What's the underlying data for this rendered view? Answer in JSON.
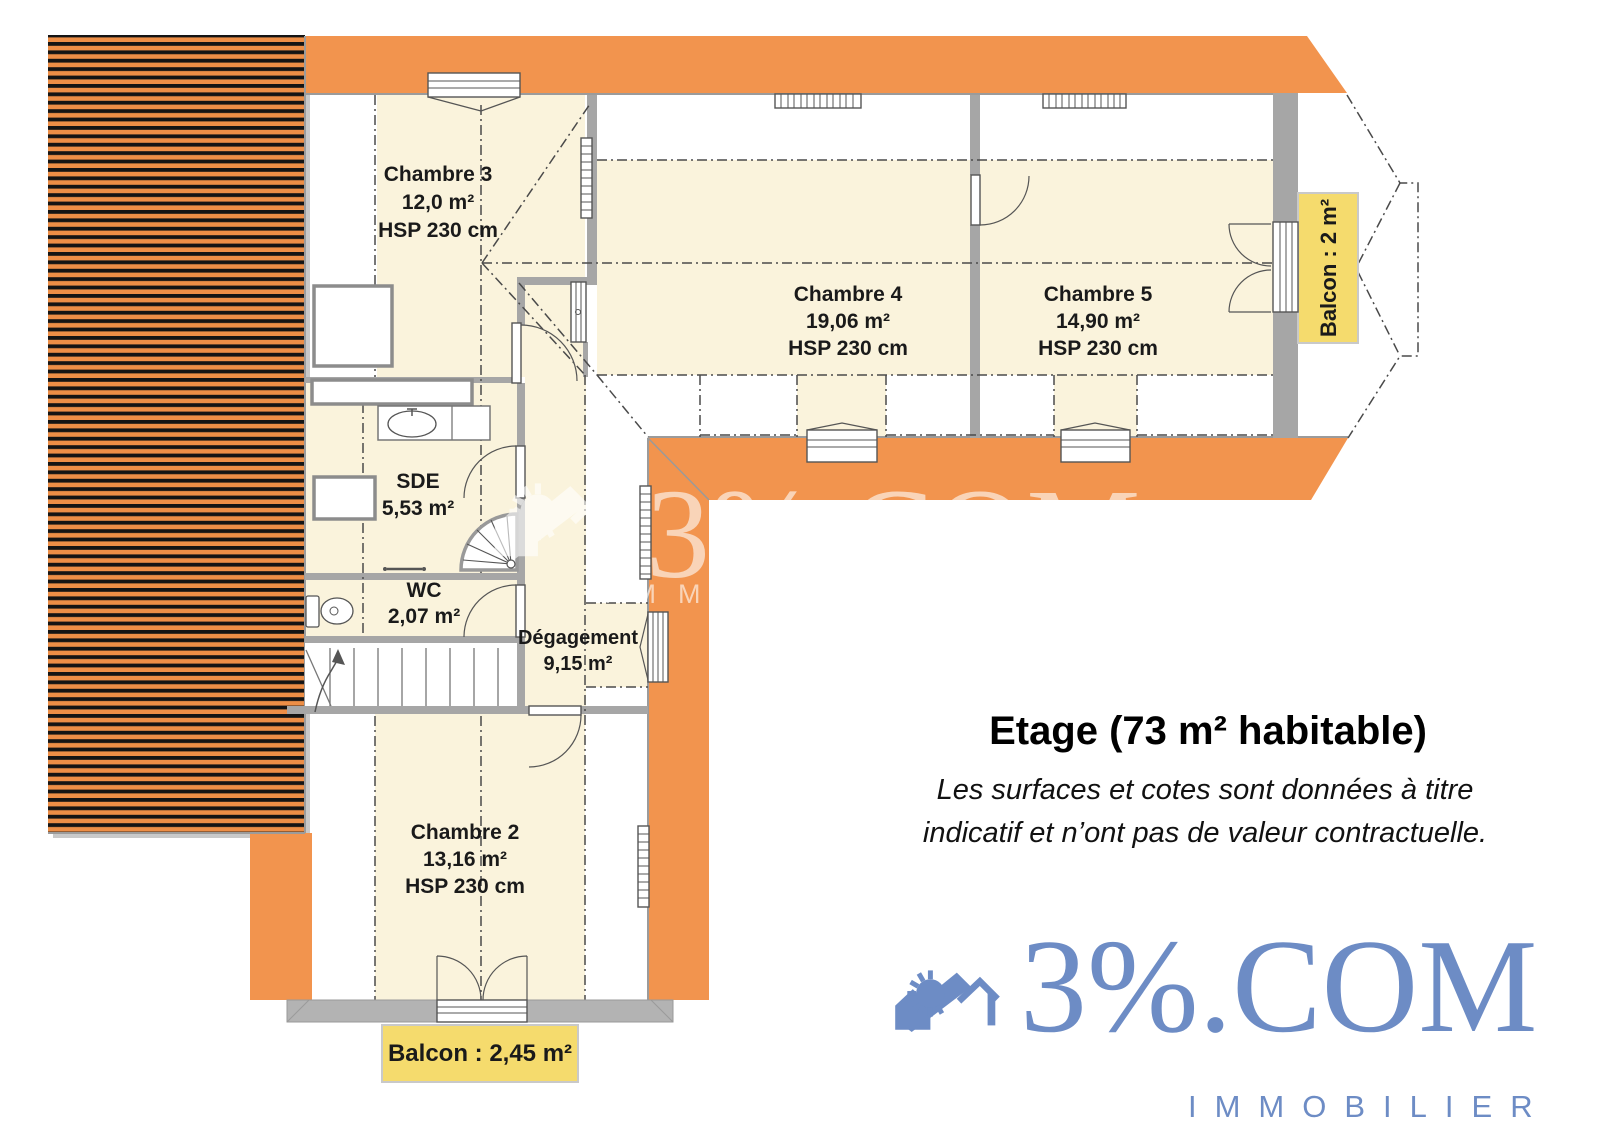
{
  "plan": {
    "rooms": [
      {
        "name": "Chambre 3",
        "area": "12,0 m²",
        "height": "HSP 230 cm"
      },
      {
        "name": "Chambre 4",
        "area": "19,06 m²",
        "height": "HSP 230 cm"
      },
      {
        "name": "Chambre 5",
        "area": "14,90 m²",
        "height": "HSP 230 cm"
      },
      {
        "name": "SDE",
        "area": "5,53 m²"
      },
      {
        "name": "WC",
        "area": "2,07 m²"
      },
      {
        "name": "Dégagement",
        "area": "9,15 m²"
      },
      {
        "name": "Chambre 2",
        "area": "13,16 m²",
        "height": "HSP 230 cm"
      }
    ],
    "balconies": [
      {
        "label": "Balcon : 2 m²"
      },
      {
        "label": "Balcon : 2,45 m²"
      }
    ]
  },
  "legend": {
    "title": "Etage (73 m² habitable)",
    "disclaimer": [
      "Les surfaces et cotes sont données à titre",
      "indicatif et n’ont pas de valeur contractuelle."
    ]
  },
  "branding": {
    "name": "3%.COM",
    "tagline": "IMMOBILIER",
    "color": "#6D8CC5"
  },
  "watermark": {
    "name": "3%.COM",
    "tagline": "IMMOBILIER"
  },
  "colors": {
    "roof_orange": "#F2944E",
    "hatch_orange": "#ED8E46",
    "room_cream": "#FAF3DC",
    "wall_gray": "#A6A6A6",
    "balcony_yellow": "#F5DB6D",
    "terrace_gray": "#B3B3B3",
    "logo_blue": "#6D8CC5"
  }
}
